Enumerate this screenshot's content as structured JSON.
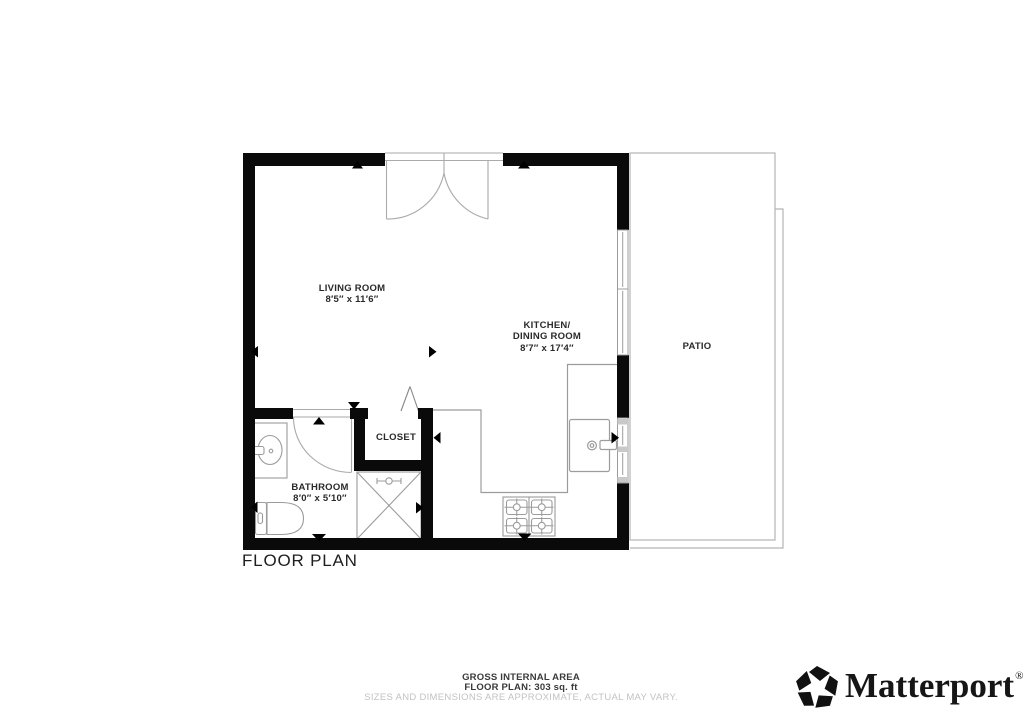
{
  "floor_plan": {
    "title": "FLOOR PLAN",
    "rooms": {
      "living": {
        "name": "LIVING ROOM",
        "dims": "8′5″ x 11′6″"
      },
      "kitchen": {
        "name_line1": "KITCHEN/",
        "name_line2": "DINING ROOM",
        "dims": "8′7″ x 17′4″"
      },
      "bathroom": {
        "name": "BATHROOM",
        "dims": "8′0″ x 5′10″"
      },
      "closet": {
        "name": "CLOSET"
      },
      "patio": {
        "name": "PATIO"
      }
    }
  },
  "footer": {
    "area_title": "GROSS INTERNAL AREA",
    "area_detail": "FLOOR PLAN: 303 sq. ft",
    "disclaimer": "SIZES AND DIMENSIONS ARE APPROXIMATE, ACTUAL MAY VARY."
  },
  "brand": {
    "wordmark": "Matterport",
    "registered_mark": "®"
  },
  "colors": {
    "wall": "#0a0a0a",
    "fixture_line": "#9c9c9c",
    "patio_line": "#b5b5b5",
    "label_text": "#2a2a2a",
    "disclaimer_text": "#c2c2c2"
  },
  "icons": {
    "logo": "matterport-pinwheel-icon",
    "markers": "direction-triangle-marker"
  }
}
